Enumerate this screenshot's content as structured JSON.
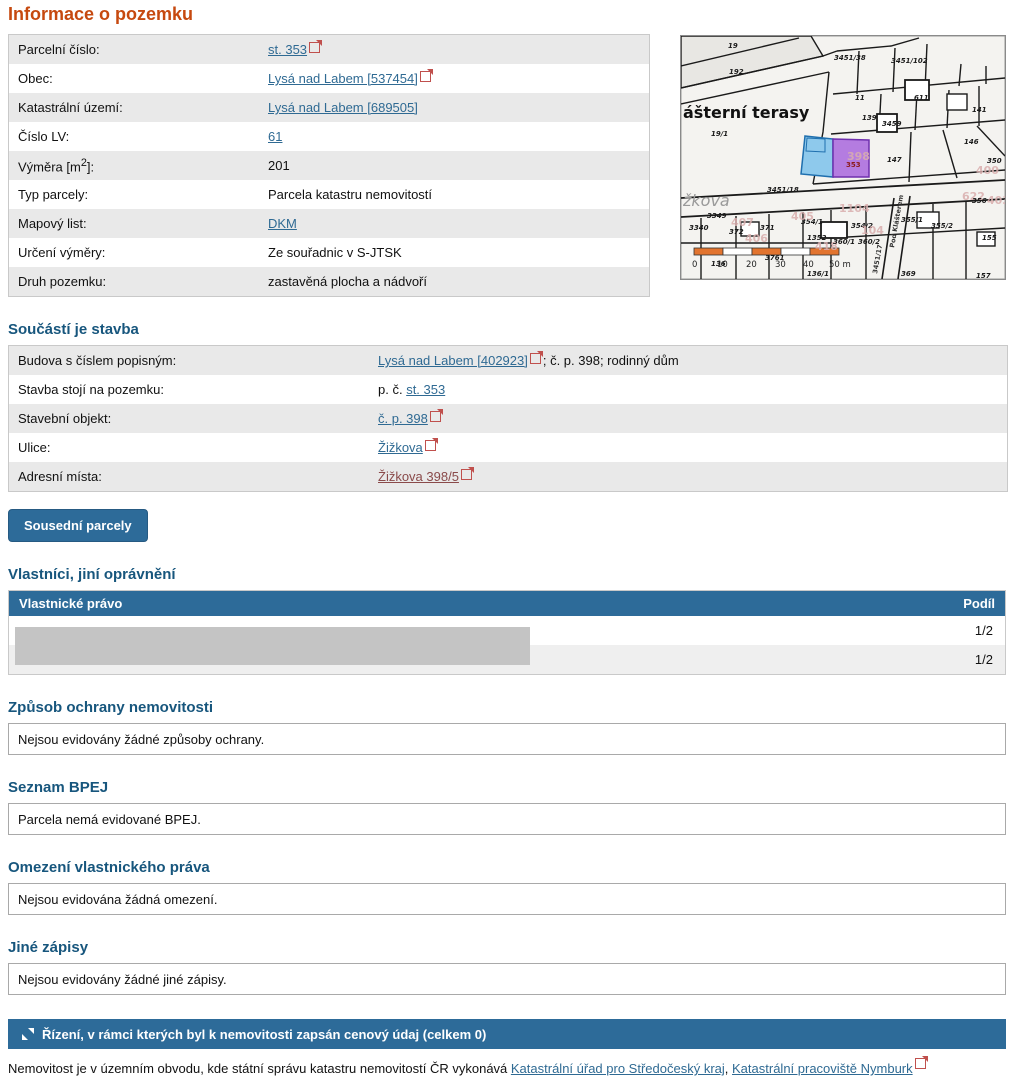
{
  "page": {
    "title": "Informace o pozemku"
  },
  "colors": {
    "accent_orange": "#c6490f",
    "heading_blue": "#17567d",
    "bar_blue": "#2d6b99",
    "link_blue": "#2f6a93",
    "link_visited": "#8a4a4a",
    "ext_icon_red": "#c0504d",
    "row_alt_gray": "#e9e9e9",
    "highlight_parcel_purple": "#b47ce0",
    "neighbor_parcel_blue": "#8ec9ec",
    "scalebar_orange": "#e2742f"
  },
  "info_table": {
    "rows": [
      {
        "label": "Parcelní číslo:",
        "value": {
          "link": "st. 353",
          "ext": true
        }
      },
      {
        "label": "Obec:",
        "value": {
          "link": "Lysá nad Labem [537454]",
          "ext": true
        }
      },
      {
        "label": "Katastrální území:",
        "value": {
          "link": "Lysá nad Labem [689505]",
          "ext": false
        }
      },
      {
        "label": "Číslo LV:",
        "value": {
          "link": "61",
          "ext": false
        }
      },
      {
        "label": "Výměra [m",
        "sup": "2",
        "label2": "]:",
        "value": {
          "text": "201"
        }
      },
      {
        "label": "Typ parcely:",
        "value": {
          "text": "Parcela katastru nemovitostí"
        }
      },
      {
        "label": "Mapový list:",
        "value": {
          "link": "DKM",
          "ext": false
        }
      },
      {
        "label": "Určení výměry:",
        "value": {
          "text": "Ze souřadnic v S-JTSK"
        }
      },
      {
        "label": "Druh pozemku:",
        "value": {
          "text": "zastavěná plocha a nádvoří"
        }
      }
    ]
  },
  "stavba": {
    "heading": "Součástí je stavba",
    "rows": [
      {
        "label": "Budova s číslem popisným:",
        "value": {
          "link": "Lysá nad Labem [402923]",
          "ext": true,
          "post": "; č. p. 398; rodinný dům"
        }
      },
      {
        "label": "Stavba stojí na pozemku:",
        "value": {
          "pre": "p. č. ",
          "link": "st. 353",
          "ext": false
        }
      },
      {
        "label": "Stavební objekt:",
        "value": {
          "link": "č. p. 398",
          "ext": true
        }
      },
      {
        "label": "Ulice:",
        "value": {
          "link": "Žižkova",
          "ext": true
        }
      },
      {
        "label": "Adresní místa:",
        "value": {
          "link": "Žižkova 398/5",
          "ext": true,
          "visited": true
        }
      }
    ]
  },
  "neighbors_button": "Sousední parcely",
  "owners": {
    "heading": "Vlastníci, jiní oprávnění",
    "col_right": "Vlastnické právo",
    "col_share": "Podíl",
    "rows": [
      {
        "share": "1/2"
      },
      {
        "share": "1/2"
      }
    ]
  },
  "sections": [
    {
      "heading": "Způsob ochrany nemovitosti",
      "text": "Nejsou evidovány žádné způsoby ochrany."
    },
    {
      "heading": "Seznam BPEJ",
      "text": "Parcela nemá evidované BPEJ."
    },
    {
      "heading": "Omezení vlastnického práva",
      "text": "Nejsou evidována žádná omezení."
    },
    {
      "heading": "Jiné zápisy",
      "text": "Nejsou evidovány žádné jiné zápisy."
    }
  ],
  "rizeni_bar": {
    "label": "Řízení, v rámci kterých byl k nemovitosti zapsán cenový údaj (celkem 0)"
  },
  "footer": {
    "pre": "Nemovitost je v územním obvodu, kde státní správu katastru nemovitostí ČR vykonává ",
    "link1": "Katastrální úřad pro Středočeský kraj",
    "sep": ", ",
    "link2": "Katastrální pracoviště Nymburk"
  },
  "map": {
    "highlighted_parcel": "353",
    "scale_labels": [
      {
        "t": "0",
        "x": 11,
        "y": 231
      },
      {
        "t": "10",
        "x": 36,
        "y": 231
      },
      {
        "t": "20",
        "x": 65,
        "y": 231
      },
      {
        "t": "30",
        "x": 94,
        "y": 231
      },
      {
        "t": "40",
        "x": 122,
        "y": 231
      },
      {
        "t": "50 m",
        "x": 148,
        "y": 231
      }
    ],
    "labels": [
      {
        "t": "ášterní terasy",
        "x": 2,
        "y": 82,
        "k": "area"
      },
      {
        "t": "žkova",
        "x": 2,
        "y": 170,
        "k": "street"
      },
      {
        "t": "Pod Klášterem",
        "x": 213,
        "y": 212,
        "k": "vstreet",
        "rot": -80
      },
      {
        "t": "19",
        "x": 47,
        "y": 12,
        "k": "num"
      },
      {
        "t": "192",
        "x": 48,
        "y": 38,
        "k": "num"
      },
      {
        "t": "19/1",
        "x": 30,
        "y": 100,
        "k": "num"
      },
      {
        "t": "3451/38",
        "x": 153,
        "y": 24,
        "k": "num"
      },
      {
        "t": "3451/102",
        "x": 210,
        "y": 27,
        "k": "num"
      },
      {
        "t": "11",
        "x": 174,
        "y": 64,
        "k": "num"
      },
      {
        "t": "611",
        "x": 233,
        "y": 64,
        "k": "num"
      },
      {
        "t": "141",
        "x": 291,
        "y": 76,
        "k": "num"
      },
      {
        "t": "139",
        "x": 181,
        "y": 84,
        "k": "num"
      },
      {
        "t": "3459",
        "x": 201,
        "y": 90,
        "k": "num"
      },
      {
        "t": "146",
        "x": 283,
        "y": 108,
        "k": "num"
      },
      {
        "t": "147",
        "x": 206,
        "y": 126,
        "k": "num"
      },
      {
        "t": "350",
        "x": 306,
        "y": 127,
        "k": "num"
      },
      {
        "t": "398",
        "x": 166,
        "y": 124,
        "k": "pink"
      },
      {
        "t": "353",
        "x": 165,
        "y": 131,
        "k": "hl"
      },
      {
        "t": "400",
        "x": 295,
        "y": 138,
        "k": "pink"
      },
      {
        "t": "3451/18",
        "x": 86,
        "y": 156,
        "k": "num"
      },
      {
        "t": "1104",
        "x": 158,
        "y": 176,
        "k": "pink"
      },
      {
        "t": "622",
        "x": 281,
        "y": 164,
        "k": "pink"
      },
      {
        "t": "403",
        "x": 306,
        "y": 168,
        "k": "pink"
      },
      {
        "t": "355/1",
        "x": 220,
        "y": 186,
        "k": "num"
      },
      {
        "t": "355/2",
        "x": 250,
        "y": 192,
        "k": "num"
      },
      {
        "t": "356",
        "x": 291,
        "y": 167,
        "k": "num"
      },
      {
        "t": "354/1",
        "x": 120,
        "y": 188,
        "k": "num"
      },
      {
        "t": "354/2",
        "x": 170,
        "y": 192,
        "k": "num"
      },
      {
        "t": "3349",
        "x": 26,
        "y": 182,
        "k": "num"
      },
      {
        "t": "3340",
        "x": 8,
        "y": 194,
        "k": "num"
      },
      {
        "t": "407",
        "x": 50,
        "y": 190,
        "k": "pink"
      },
      {
        "t": "372",
        "x": 48,
        "y": 198,
        "k": "num"
      },
      {
        "t": "371",
        "x": 79,
        "y": 194,
        "k": "num"
      },
      {
        "t": "406",
        "x": 64,
        "y": 206,
        "k": "pink"
      },
      {
        "t": "405",
        "x": 110,
        "y": 184,
        "k": "pink"
      },
      {
        "t": "1352",
        "x": 126,
        "y": 204,
        "k": "num"
      },
      {
        "t": "418",
        "x": 134,
        "y": 214,
        "k": "pink"
      },
      {
        "t": "104",
        "x": 180,
        "y": 198,
        "k": "pink"
      },
      {
        "t": "360/1",
        "x": 152,
        "y": 208,
        "k": "num"
      },
      {
        "t": "360/2",
        "x": 177,
        "y": 208,
        "k": "num"
      },
      {
        "t": "3761",
        "x": 84,
        "y": 224,
        "k": "num"
      },
      {
        "t": "136",
        "x": 30,
        "y": 230,
        "k": "num"
      },
      {
        "t": "136/1",
        "x": 126,
        "y": 240,
        "k": "num"
      },
      {
        "t": "3451/17",
        "x": 196,
        "y": 238,
        "k": "vstreet",
        "rot": -80
      },
      {
        "t": "369",
        "x": 220,
        "y": 240,
        "k": "num"
      },
      {
        "t": "155",
        "x": 301,
        "y": 204,
        "k": "num"
      },
      {
        "t": "157",
        "x": 295,
        "y": 242,
        "k": "num"
      }
    ]
  }
}
